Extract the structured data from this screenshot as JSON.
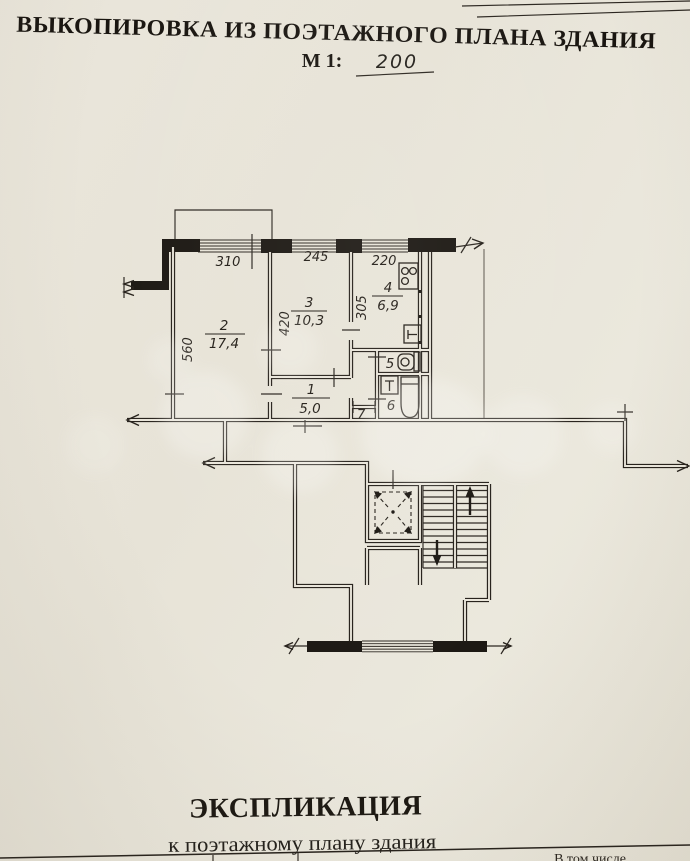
{
  "document": {
    "title": "ВЫКОПИРОВКА ИЗ ПОЭТАЖНОГО ПЛАНА ЗДАНИЯ",
    "scale_label": "М 1:",
    "scale_value": "200"
  },
  "plan": {
    "window_dimensions": {
      "w1": "310",
      "w2": "245",
      "w3": "220"
    },
    "depth_dimensions": {
      "room2": "560",
      "room3": "420",
      "kitchen": "305"
    },
    "rooms": {
      "hall": {
        "number": "1",
        "area": "5,0"
      },
      "living": {
        "number": "2",
        "area": "17,4"
      },
      "bedroom": {
        "number": "3",
        "area": "10,3"
      },
      "kitchen": {
        "number": "4",
        "area": "6,9"
      },
      "wc": {
        "number": "5"
      },
      "bathroom": {
        "number": "6"
      },
      "closet": {
        "number": "7"
      }
    }
  },
  "explication": {
    "title": "ЭКСПЛИКАЦИЯ",
    "subtitle": "к поэтажному плану здания",
    "table_partial_header": "В том числе"
  },
  "colors": {
    "paper": "#e9e5da",
    "ink": "#221d17"
  }
}
